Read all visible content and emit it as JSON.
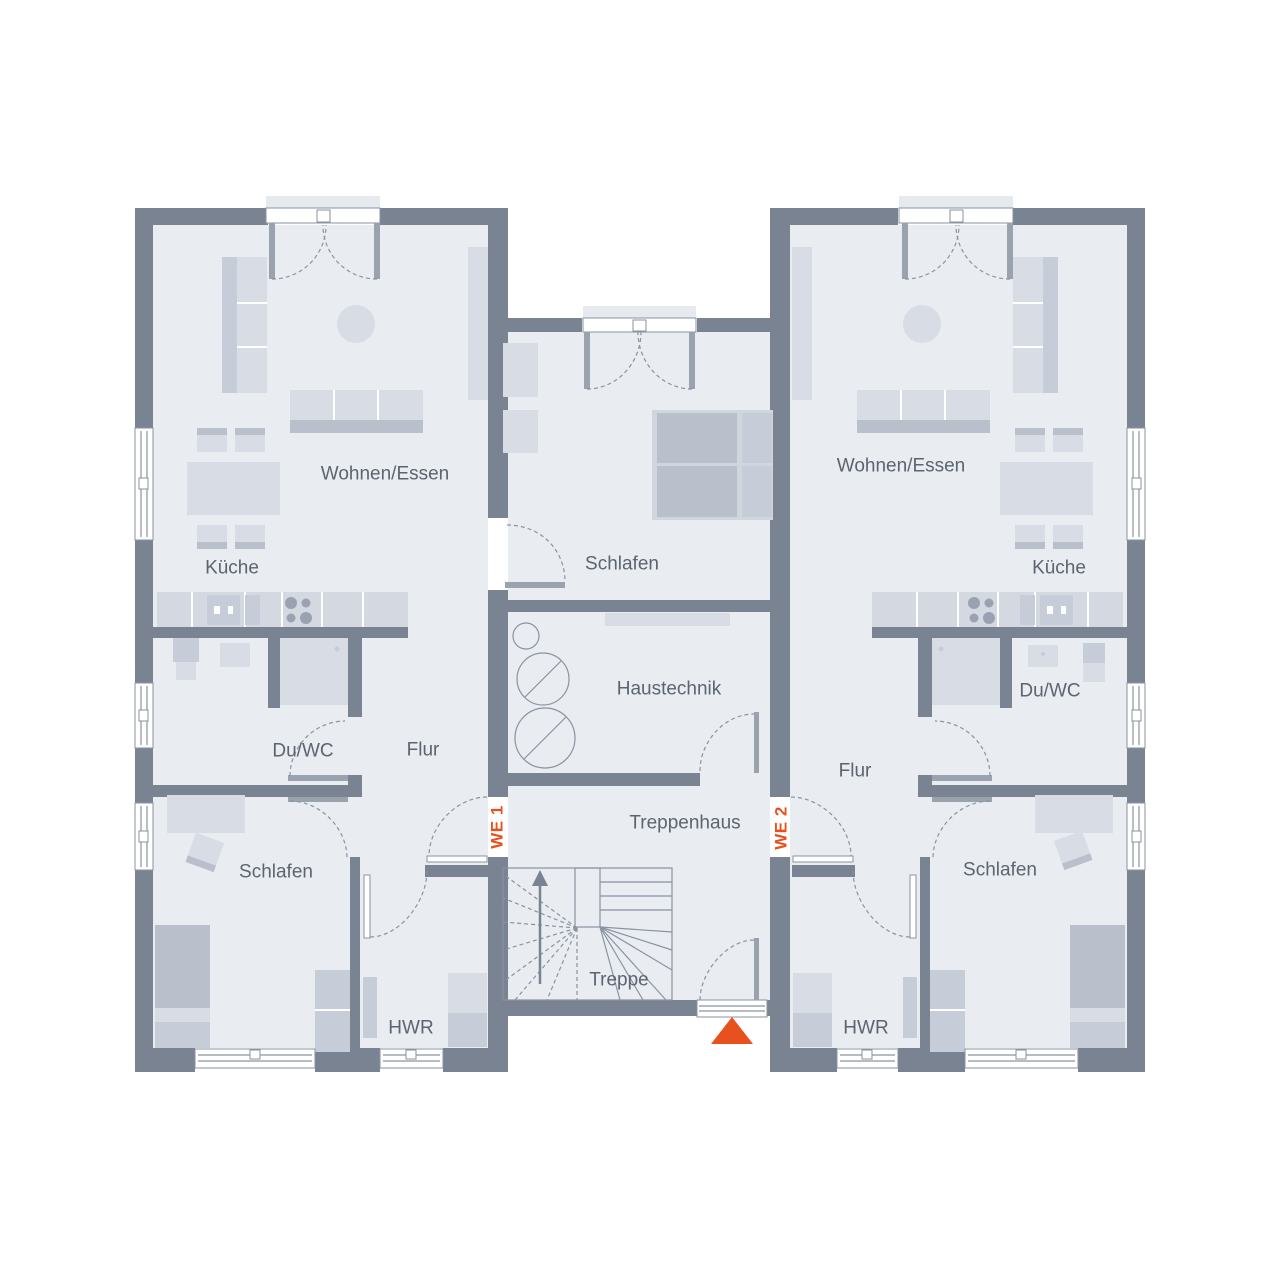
{
  "colors": {
    "wall": "#7a8392",
    "floor": "#e9edf2",
    "accent": "#e8501e",
    "label": "#5c6470",
    "furniture-light": "#d8dce5",
    "furniture-mid": "#c6ccd8",
    "furniture-dark": "#b9c0cc",
    "counter": "#d4d8e1",
    "line": "#8a93a1"
  },
  "units": {
    "unit1": {
      "badge": "WE 1",
      "rooms": {
        "wohnen_essen": "Wohnen/Essen",
        "kueche": "Küche",
        "du_wc": "Du/WC",
        "flur": "Flur",
        "schlafen": "Schlafen",
        "hwr": "HWR"
      }
    },
    "unit2": {
      "badge": "WE 2",
      "rooms": {
        "wohnen_essen": "Wohnen/Essen",
        "kueche": "Küche",
        "du_wc": "Du/WC",
        "flur": "Flur",
        "schlafen": "Schlafen",
        "hwr": "HWR"
      }
    }
  },
  "shared": {
    "rooms": {
      "schlafen": "Schlafen",
      "haustechnik": "Haustechnik",
      "treppenhaus": "Treppenhaus",
      "treppe": "Treppe"
    }
  }
}
